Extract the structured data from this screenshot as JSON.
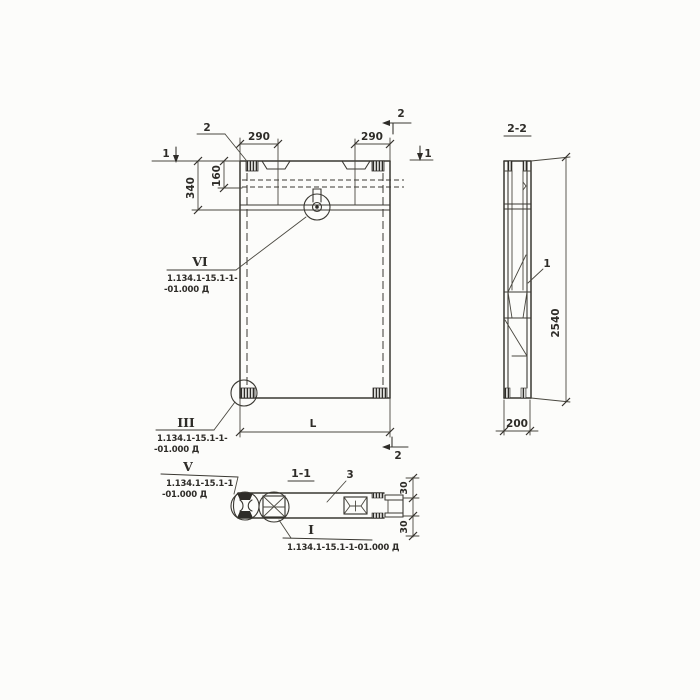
{
  "elevation": {
    "cut_marker_1_left": "1",
    "cut_marker_1_right": "1",
    "cut_marker_2_top": "2",
    "cut_marker_2_right": "2",
    "cut_marker_2_bottom": "2",
    "dim_notch_left": "290",
    "dim_notch_right": "290",
    "dim_top_band": "340",
    "dim_top_recess": "160",
    "dim_length": "L"
  },
  "section_2_2": {
    "title": "2-2",
    "dim_height": "2540",
    "dim_thickness": "200",
    "callout": "1"
  },
  "section_1_1": {
    "title": "1-1",
    "callout": "3",
    "dim_flange_top": "30",
    "dim_flange_bottom": "30"
  },
  "details": {
    "vi": {
      "mark": "VI",
      "ref1": "1.134.1-15.1-1-",
      "ref2": "-01.000 Д"
    },
    "iii": {
      "mark": "III",
      "ref1": "1.134.1-15.1-1-",
      "ref2": "-01.000 Д"
    },
    "v": {
      "mark": "V",
      "ref1": "1.134.1-15.1-1",
      "ref2": "-01.000 Д"
    },
    "i": {
      "mark": "I",
      "ref": "1.134.1-15.1-1-01.000 Д"
    }
  }
}
